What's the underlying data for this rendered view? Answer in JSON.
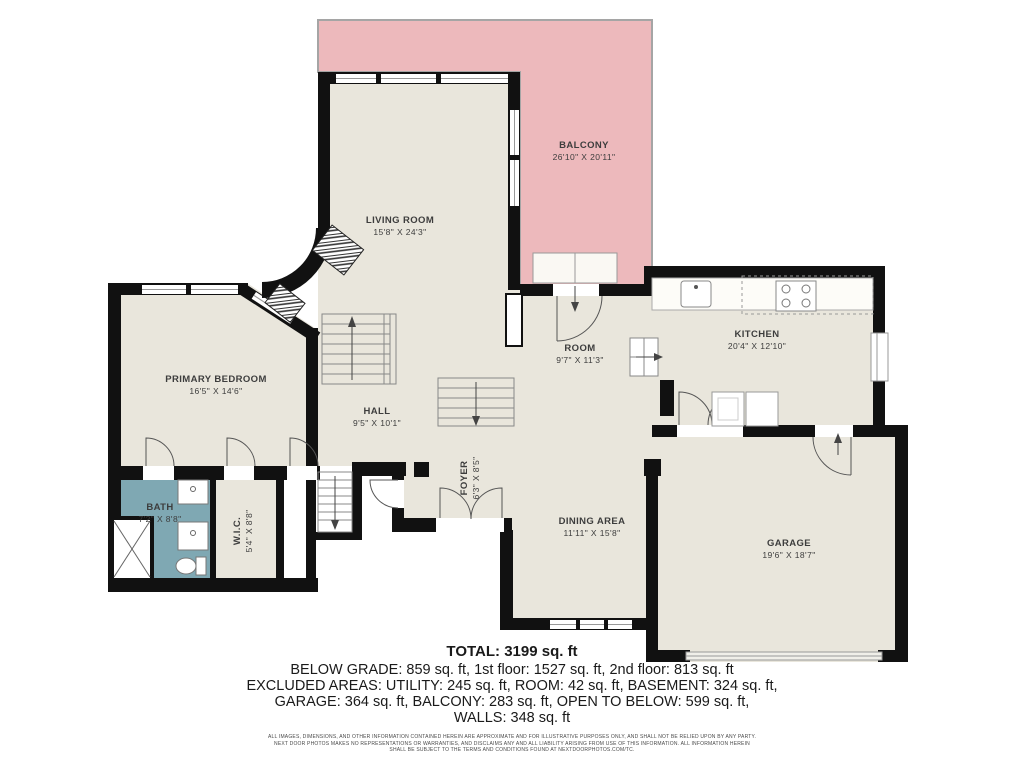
{
  "rooms": {
    "balcony": {
      "name": "BALCONY",
      "dims": "26'10\" X 20'11\""
    },
    "living": {
      "name": "LIVING ROOM",
      "dims": "15'8\" X 24'3\""
    },
    "kitchen": {
      "name": "KITCHEN",
      "dims": "20'4\" X 12'10\""
    },
    "room": {
      "name": "ROOM",
      "dims": "9'7\" X 11'3\""
    },
    "primary": {
      "name": "PRIMARY BEDROOM",
      "dims": "16'5\" X 14'6\""
    },
    "hall": {
      "name": "HALL",
      "dims": "9'5\" X 10'1\""
    },
    "foyer": {
      "name": "FOYER",
      "dims": "6'3\" X 8'5\""
    },
    "bath": {
      "name": "BATH",
      "dims": "7'2\" X 8'8\""
    },
    "wic": {
      "name": "W.I.C.",
      "dims": "5'4\" X 8'8\""
    },
    "dining": {
      "name": "DINING AREA",
      "dims": "11'11\" X 15'8\""
    },
    "garage": {
      "name": "GARAGE",
      "dims": "19'6\" X 18'7\""
    }
  },
  "summary": {
    "total": "TOTAL: 3199 sq. ft",
    "line1": "BELOW GRADE: 859 sq. ft, 1st floor: 1527 sq. ft, 2nd floor: 813 sq. ft",
    "line2": "EXCLUDED AREAS: UTILITY: 245 sq. ft, ROOM: 42 sq. ft, BASEMENT: 324 sq. ft,",
    "line3": "GARAGE: 364 sq. ft, BALCONY: 283 sq. ft, OPEN TO BELOW: 599 sq. ft,",
    "line4": "WALLS: 348 sq. ft"
  },
  "disclaimer": {
    "line1": "ALL IMAGES, DIMENSIONS, AND OTHER INFORMATION CONTAINED HEREIN ARE APPROXIMATE AND FOR ILLUSTRATIVE PURPOSES ONLY, AND SHALL NOT BE RELIED UPON BY ANY PARTY.",
    "line2": "NEXT DOOR PHOTOS MAKES NO REPRESENTATIONS OR WARRANTIES, AND DISCLAIMS ANY AND ALL LIABILITY ARISING FROM USE OF THIS INFORMATION. ALL INFORMATION HEREIN",
    "line3": "SHALL BE SUBJECT TO THE TERMS AND CONDITIONS FOUND AT NEXTDOORPHOTOS.COM/TC."
  },
  "colors": {
    "floor": "#e9e6dc",
    "balcony_fill": "#edb9bc",
    "bath_fill": "#7fa8b3",
    "wall": "#111111",
    "label_text": "#3d3d3d"
  }
}
